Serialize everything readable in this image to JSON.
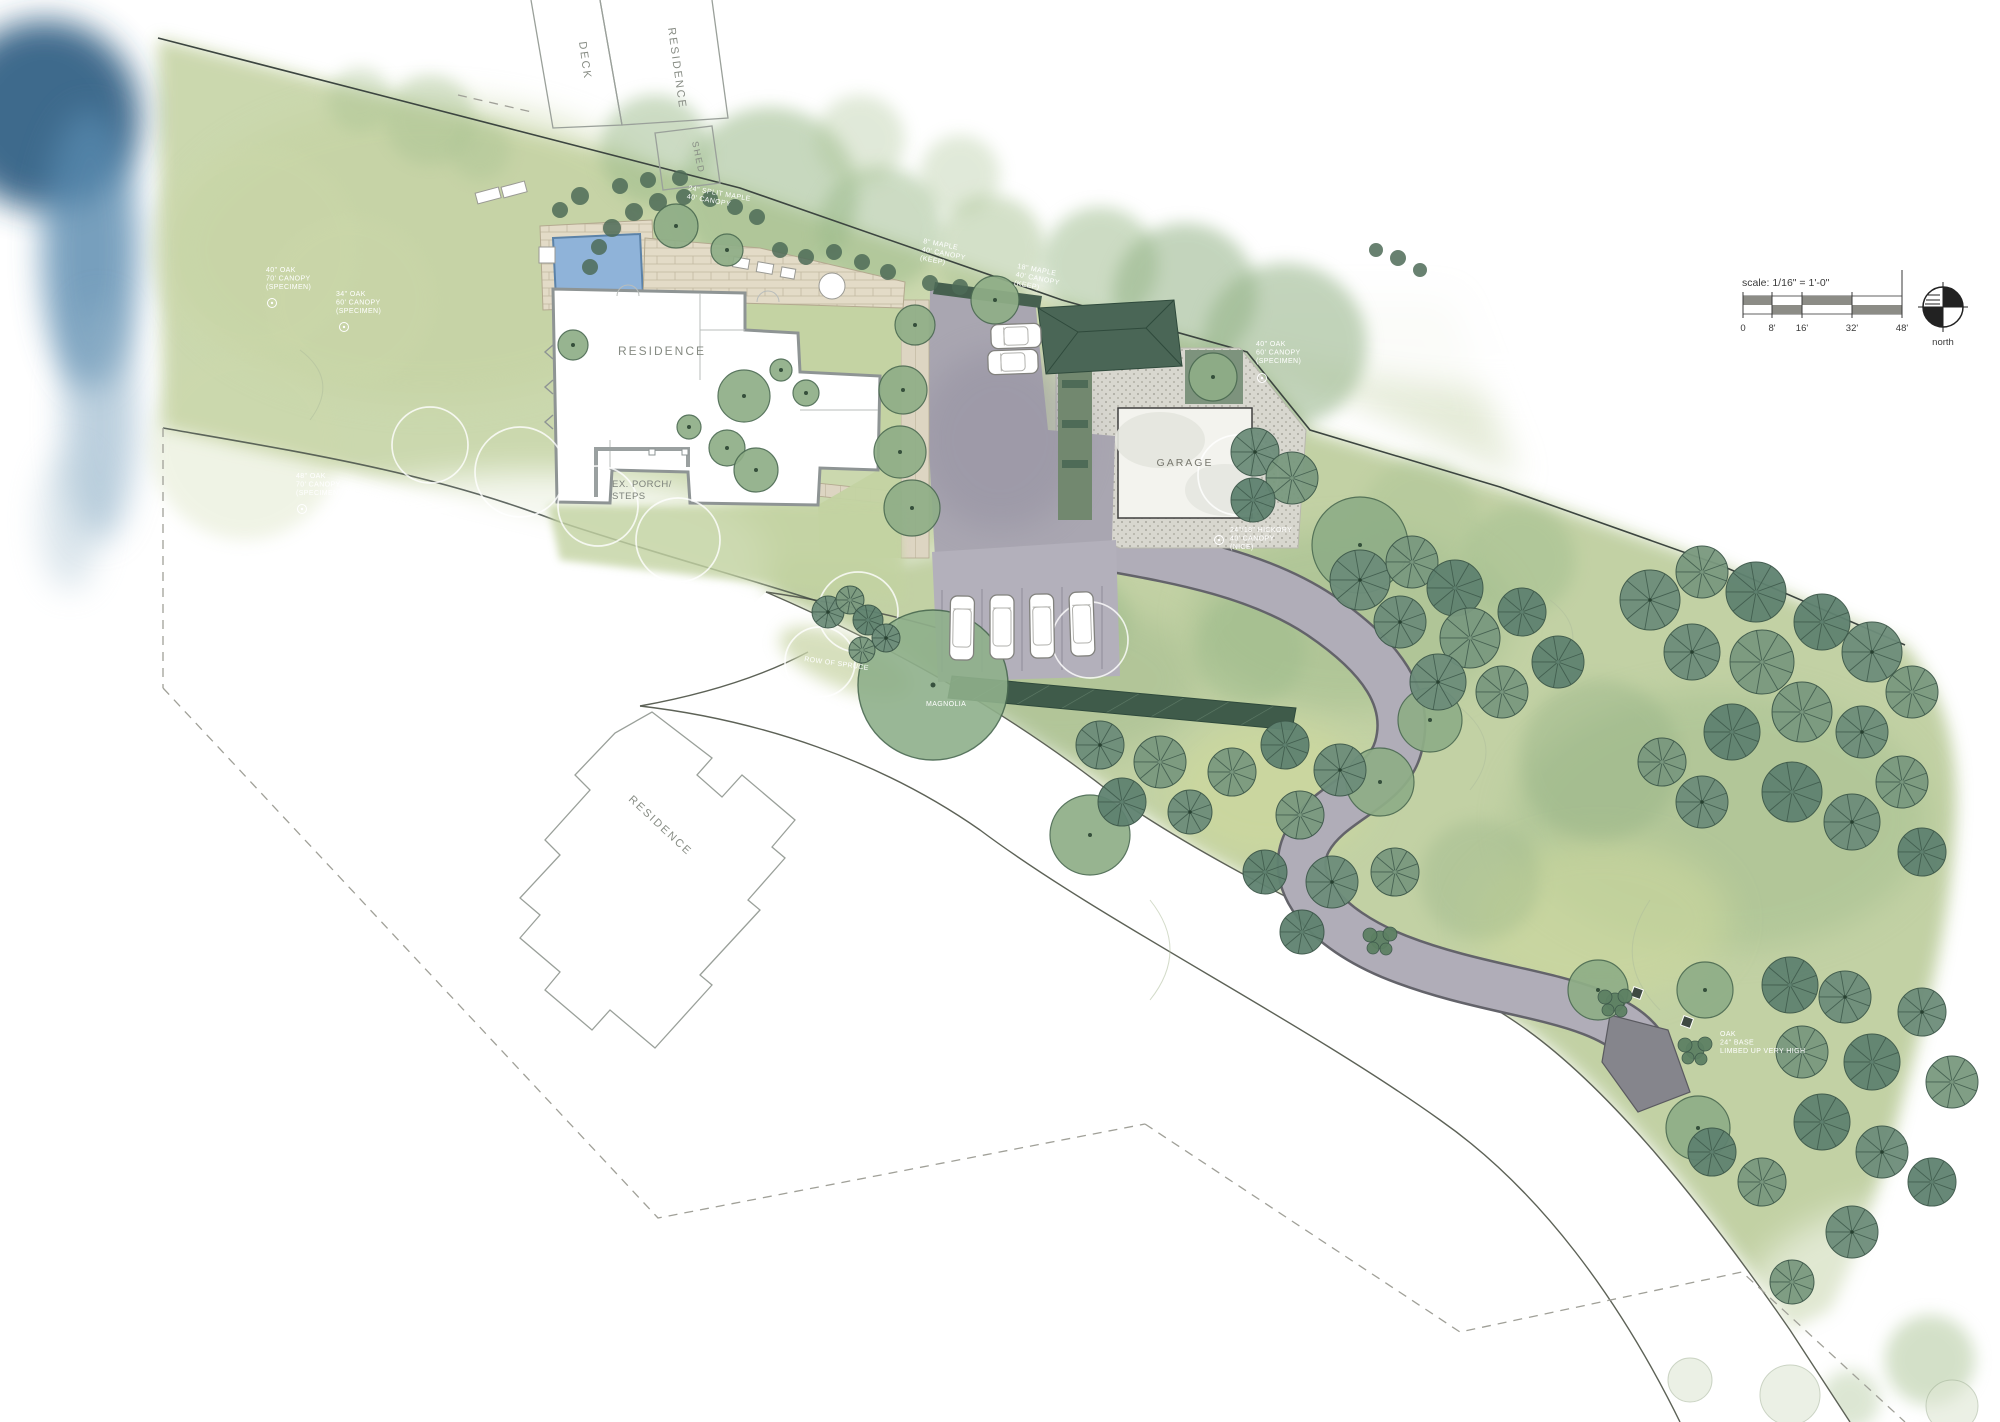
{
  "drawing": {
    "type": "residential landscape site plan",
    "scale_note": "scale: 1/16\" = 1'-0\"",
    "north_label": "north"
  },
  "labels": {
    "deck": "DECK",
    "residence_top": "RESIDENCE",
    "shed": "SHED",
    "residence_main": "RESIDENCE",
    "porch_line1": "EX. PORCH/",
    "porch_line2": "STEPS",
    "garage": "GARAGE",
    "residence_south": "RESIDENCE",
    "scale": "scale: 1/16\" = 1'-0\"",
    "north": "north"
  },
  "scale_bar": {
    "ticks": [
      {
        "x": 1743,
        "label": "0"
      },
      {
        "x": 1772,
        "label": "8'"
      },
      {
        "x": 1802,
        "label": "16'"
      },
      {
        "x": 1852,
        "label": "32'"
      },
      {
        "x": 1902,
        "label": "48'"
      }
    ]
  },
  "tree_labels": [
    {
      "x": 266,
      "y": 272,
      "rot": 0,
      "lines": [
        "40\" OAK",
        "70' CANOPY",
        "(SPECIMEN)"
      ],
      "sym": [
        272,
        303
      ]
    },
    {
      "x": 336,
      "y": 296,
      "rot": 0,
      "lines": [
        "34\" OAK",
        "60' CANOPY",
        "(SPECIMEN)"
      ],
      "sym": [
        344,
        327
      ]
    },
    {
      "x": 296,
      "y": 478,
      "rot": 0,
      "lines": [
        "48\" OAK",
        "70' CANOPY",
        "(SPECIMEN)"
      ],
      "sym": [
        302,
        509
      ]
    },
    {
      "x": 688,
      "y": 190,
      "rot": 10,
      "lines": [
        "24\" SPLIT MAPLE",
        "40' CANOPY"
      ],
      "sym": null
    },
    {
      "x": 923,
      "y": 243,
      "rot": 11,
      "lines": [
        "8\" MAPLE",
        "40' CANOPY",
        "(KEEP)"
      ],
      "sym": null
    },
    {
      "x": 1017,
      "y": 268,
      "rot": 11,
      "lines": [
        "18\" MAPLE",
        "40' CANOPY",
        "(KEEP)"
      ],
      "sym": null
    },
    {
      "x": 1256,
      "y": 346,
      "rot": 0,
      "lines": [
        "40\" OAK",
        "60' CANOPY",
        "(SPECIMEN)"
      ],
      "sym": [
        1262,
        378
      ]
    },
    {
      "x": 1230,
      "y": 532,
      "rot": 0,
      "lines": [
        "24\"/18\" HICKORY",
        "40' CANOPY",
        "(NICE)"
      ],
      "sym": [
        1219,
        540
      ]
    },
    {
      "x": 1720,
      "y": 1036,
      "rot": 0,
      "lines": [
        "OAK",
        "24\" BASE",
        "LIMBED UP VERY HIGH"
      ],
      "sym": null
    },
    {
      "x": 804,
      "y": 661,
      "rot": 8,
      "lines": [
        "ROW OF SPRUCE"
      ],
      "sym": null
    },
    {
      "x": 926,
      "y": 706,
      "rot": 0,
      "lines": [
        "MAGNOLIA"
      ],
      "sym": null
    }
  ],
  "vegetation": {
    "soft_trees": [
      [
        255,
        250,
        105,
        0.32,
        "#cdd9ab"
      ],
      [
        350,
        300,
        85,
        0.3,
        "#cdd9ab"
      ],
      [
        245,
        445,
        95,
        0.3,
        "#cdd9ab"
      ],
      [
        430,
        120,
        45,
        0.45,
        "#a9c293"
      ],
      [
        360,
        100,
        32,
        0.4,
        "#a9c293"
      ],
      [
        480,
        150,
        30,
        0.4,
        "#a9c293"
      ],
      [
        655,
        150,
        55,
        0.5,
        "#9ab989"
      ],
      [
        770,
        195,
        88,
        0.55,
        "#9ab989"
      ],
      [
        880,
        228,
        62,
        0.5,
        "#9ab989"
      ],
      [
        990,
        250,
        55,
        0.5,
        "#a9c293"
      ],
      [
        1100,
        265,
        58,
        0.5,
        "#9ab989"
      ],
      [
        1185,
        295,
        72,
        0.55,
        "#93b286"
      ],
      [
        1285,
        345,
        82,
        0.55,
        "#93b286"
      ],
      [
        960,
        175,
        40,
        0.35,
        "#a9c293"
      ],
      [
        860,
        140,
        45,
        0.35,
        "#a9c293"
      ],
      [
        1420,
        520,
        60,
        0.4,
        "#a9c293"
      ],
      [
        1520,
        560,
        55,
        0.4,
        "#9ab989"
      ],
      [
        1080,
        620,
        50,
        0.4,
        "#9ab989"
      ],
      [
        1250,
        650,
        55,
        0.4,
        "#9ab989"
      ],
      [
        1600,
        760,
        80,
        0.35,
        "#8fae82"
      ],
      [
        1480,
        880,
        60,
        0.3,
        "#8fae82"
      ],
      [
        1930,
        1360,
        45,
        0.5,
        "#a9c293"
      ],
      [
        1850,
        1400,
        30,
        0.4,
        "#a9c293"
      ]
    ],
    "fan_trees": [
      [
        1255,
        452,
        24
      ],
      [
        1292,
        478,
        26
      ],
      [
        1253,
        500,
        22
      ],
      [
        1360,
        580,
        30
      ],
      [
        1412,
        562,
        26
      ],
      [
        1455,
        588,
        28
      ],
      [
        1400,
        622,
        26
      ],
      [
        1470,
        638,
        30
      ],
      [
        1522,
        612,
        24
      ],
      [
        1438,
        682,
        28
      ],
      [
        1502,
        692,
        26
      ],
      [
        1558,
        662,
        26
      ],
      [
        1650,
        600,
        30
      ],
      [
        1702,
        572,
        26
      ],
      [
        1756,
        592,
        30
      ],
      [
        1692,
        652,
        28
      ],
      [
        1762,
        662,
        32
      ],
      [
        1822,
        622,
        28
      ],
      [
        1872,
        652,
        30
      ],
      [
        1802,
        712,
        30
      ],
      [
        1732,
        732,
        28
      ],
      [
        1862,
        732,
        26
      ],
      [
        1912,
        692,
        26
      ],
      [
        1792,
        792,
        30
      ],
      [
        1852,
        822,
        28
      ],
      [
        1902,
        782,
        26
      ],
      [
        1922,
        852,
        24
      ],
      [
        1702,
        802,
        26
      ],
      [
        1662,
        762,
        24
      ],
      [
        1285,
        745,
        24
      ],
      [
        1340,
        770,
        26
      ],
      [
        1300,
        815,
        24
      ],
      [
        1265,
        872,
        22
      ],
      [
        1332,
        882,
        26
      ],
      [
        1395,
        872,
        24
      ],
      [
        1302,
        932,
        22
      ],
      [
        1100,
        745,
        24
      ],
      [
        1160,
        762,
        26
      ],
      [
        1122,
        802,
        24
      ],
      [
        1190,
        812,
        22
      ],
      [
        1232,
        772,
        24
      ],
      [
        1790,
        985,
        28
      ],
      [
        1845,
        997,
        26
      ],
      [
        1802,
        1052,
        26
      ],
      [
        1872,
        1062,
        28
      ],
      [
        1922,
        1012,
        24
      ],
      [
        1952,
        1082,
        26
      ],
      [
        1822,
        1122,
        28
      ],
      [
        1882,
        1152,
        26
      ],
      [
        1762,
        1182,
        24
      ],
      [
        1932,
        1182,
        24
      ],
      [
        1852,
        1232,
        26
      ],
      [
        1792,
        1282,
        22
      ],
      [
        1712,
        1152,
        24
      ],
      [
        828,
        612,
        16
      ],
      [
        850,
        600,
        14
      ],
      [
        868,
        620,
        15
      ],
      [
        886,
        638,
        14
      ],
      [
        862,
        650,
        13
      ]
    ],
    "round_trees": [
      [
        915,
        325,
        20
      ],
      [
        903,
        390,
        24
      ],
      [
        900,
        452,
        26
      ],
      [
        912,
        508,
        28
      ],
      [
        995,
        300,
        24
      ],
      [
        744,
        396,
        26
      ],
      [
        727,
        448,
        18
      ],
      [
        756,
        470,
        22
      ],
      [
        689,
        427,
        12
      ],
      [
        781,
        370,
        11
      ],
      [
        806,
        393,
        13
      ],
      [
        676,
        226,
        22
      ],
      [
        727,
        250,
        16
      ],
      [
        1213,
        377,
        24
      ],
      [
        1360,
        545,
        48
      ],
      [
        1430,
        720,
        32
      ],
      [
        1380,
        782,
        34
      ],
      [
        1598,
        990,
        30
      ],
      [
        1705,
        990,
        28
      ],
      [
        1698,
        1128,
        32
      ],
      [
        1090,
        835,
        40
      ],
      [
        573,
        345,
        15
      ]
    ],
    "magnolia": [
      933,
      685,
      75
    ],
    "shrub_dots": [
      [
        612,
        228,
        9
      ],
      [
        634,
        212,
        9
      ],
      [
        658,
        202,
        9
      ],
      [
        684,
        197,
        8
      ],
      [
        710,
        199,
        8
      ],
      [
        735,
        207,
        8
      ],
      [
        757,
        217,
        8
      ],
      [
        780,
        250,
        8
      ],
      [
        806,
        257,
        8
      ],
      [
        834,
        252,
        8
      ],
      [
        862,
        262,
        8
      ],
      [
        888,
        272,
        8
      ],
      [
        599,
        247,
        8
      ],
      [
        590,
        267,
        8
      ],
      [
        560,
        210,
        8
      ],
      [
        580,
        196,
        9
      ],
      [
        620,
        186,
        8
      ],
      [
        648,
        180,
        8
      ],
      [
        680,
        178,
        8
      ],
      [
        930,
        283,
        8
      ],
      [
        960,
        287,
        8
      ],
      [
        1398,
        258,
        8
      ],
      [
        1420,
        270,
        7
      ],
      [
        1376,
        250,
        7
      ]
    ],
    "bush_clusters": [
      [
        1615,
        1002
      ],
      [
        1695,
        1050
      ],
      [
        1380,
        940
      ]
    ],
    "ghost_outlines": [
      [
        520,
        472,
        45
      ],
      [
        598,
        506,
        40
      ],
      [
        678,
        540,
        42
      ],
      [
        858,
        612,
        40
      ],
      [
        820,
        662,
        35
      ],
      [
        1238,
        475,
        40
      ],
      [
        430,
        445,
        38
      ],
      [
        1090,
        640,
        38
      ]
    ],
    "faint_trees": [
      [
        1790,
        1395,
        30
      ],
      [
        1952,
        1406,
        26
      ],
      [
        1690,
        1380,
        22
      ]
    ]
  },
  "cars": [
    [
      962,
      628,
      1,
      64
    ],
    [
      1002,
      627,
      0,
      64
    ],
    [
      1042,
      626,
      -1,
      64
    ],
    [
      1082,
      624,
      -2,
      64
    ],
    [
      1016,
      336,
      -92,
      50
    ],
    [
      1013,
      362,
      -92,
      50
    ]
  ],
  "colors": {
    "lawn_light": "#cbd7ab",
    "lawn_right": "#bfcfa0",
    "canopy_soft": "#9ab989",
    "tree_dark": "#6d8d7a",
    "hedge_dark": "#3f5b4a",
    "water_blue": "#3f6f96",
    "paving_court": "#a9a6b1",
    "driveway": "#b0adb8",
    "stone_tan": "#e3dbc7",
    "pool_blue": "#8fb3d9",
    "gravel": "#d8d7cf"
  }
}
